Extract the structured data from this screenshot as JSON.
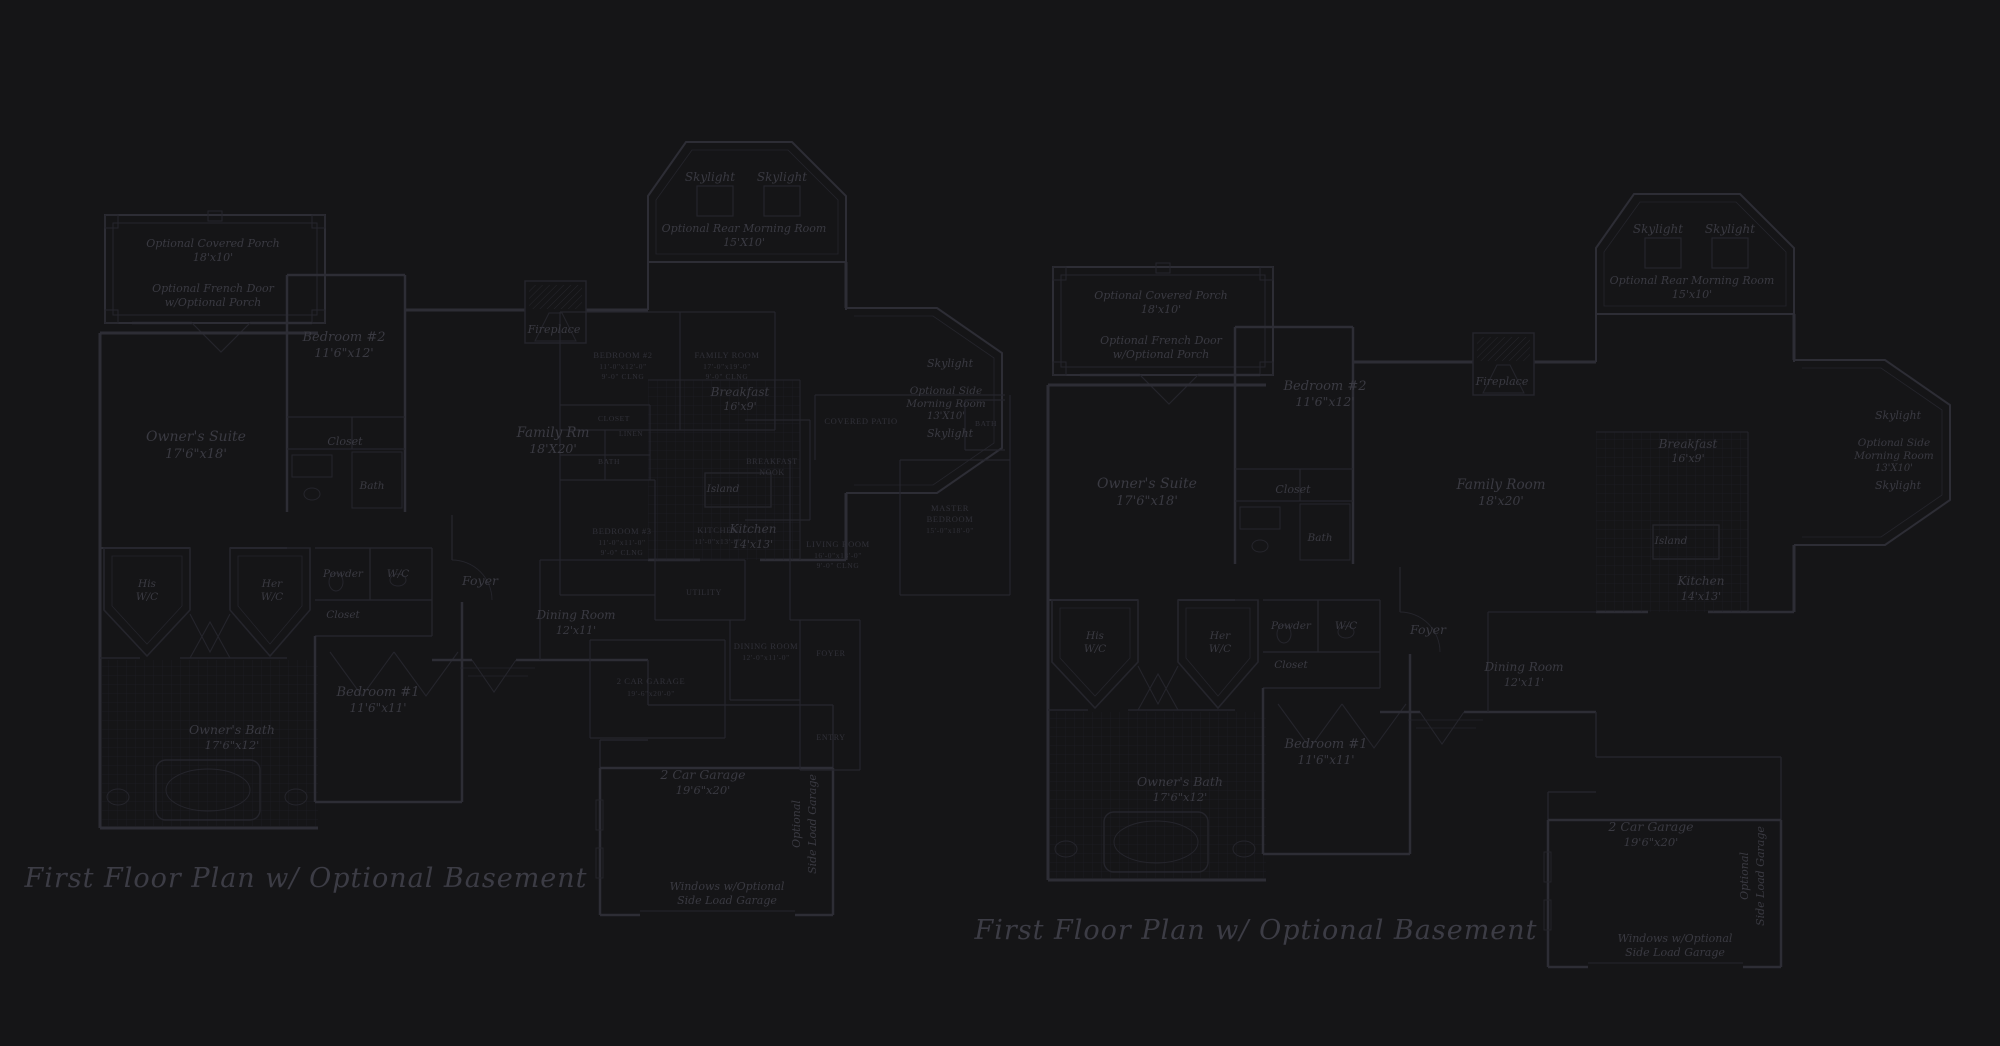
{
  "background": "#151517",
  "colors": {
    "wall_line": "#2d2d35",
    "thin_line": "#25252c",
    "overlay_line": "#26262d",
    "label_text": "#3a3a42",
    "smallcaps_text": "#313139",
    "title_text": "#3c3c45",
    "tile_grid": "#1e1e24"
  },
  "titles": [
    {
      "text": "First Floor Plan  w/ Optional Basement",
      "x": 306,
      "y": 887
    },
    {
      "text": "First Floor Plan  w/ Optional Basement",
      "x": 1256,
      "y": 939
    }
  ],
  "plans": [
    {
      "id": "left-plan",
      "labels": [
        {
          "t": "Optional Covered Porch",
          "x": 213,
          "y": 247,
          "s": 11
        },
        {
          "t": "18'x10'",
          "x": 213,
          "y": 261,
          "s": 11
        },
        {
          "t": "Optional French Door",
          "x": 213,
          "y": 292,
          "s": 11
        },
        {
          "t": "w/Optional Porch",
          "x": 213,
          "y": 306,
          "s": 11
        },
        {
          "t": "Owner's Suite",
          "x": 196,
          "y": 441,
          "s": 14
        },
        {
          "t": "17'6\"x18'",
          "x": 196,
          "y": 458,
          "s": 13
        },
        {
          "t": "Bedroom #2",
          "x": 344,
          "y": 341,
          "s": 13
        },
        {
          "t": "11'6\"x12'",
          "x": 344,
          "y": 357,
          "s": 12.5
        },
        {
          "t": "Closet",
          "x": 345,
          "y": 445,
          "s": 11
        },
        {
          "t": "Bath",
          "x": 372,
          "y": 489,
          "s": 10.5
        },
        {
          "t": "Fireplace",
          "x": 554,
          "y": 333,
          "s": 11
        },
        {
          "t": "Skylight",
          "x": 710,
          "y": 181,
          "s": 12
        },
        {
          "t": "Skylight",
          "x": 782,
          "y": 181,
          "s": 12
        },
        {
          "t": "Optional Rear Morning Room",
          "x": 744,
          "y": 232,
          "s": 11
        },
        {
          "t": "15'X10'",
          "x": 744,
          "y": 246,
          "s": 11
        },
        {
          "t": "Family Rm",
          "x": 553,
          "y": 437,
          "s": 13.5
        },
        {
          "t": "18'X20'",
          "x": 553,
          "y": 453,
          "s": 12.5
        },
        {
          "t": "Breakfast",
          "x": 740,
          "y": 396,
          "s": 12
        },
        {
          "t": "16'x9'",
          "x": 740,
          "y": 410,
          "s": 11
        },
        {
          "t": "Island",
          "x": 723,
          "y": 492,
          "s": 10.5
        },
        {
          "t": "Kitchen",
          "x": 753,
          "y": 533,
          "s": 12
        },
        {
          "t": "14'x13'",
          "x": 753,
          "y": 548,
          "s": 11
        },
        {
          "t": "His",
          "x": 147,
          "y": 587,
          "s": 10.5
        },
        {
          "t": "W/C",
          "x": 147,
          "y": 600,
          "s": 10.5
        },
        {
          "t": "Her",
          "x": 272,
          "y": 587,
          "s": 10.5
        },
        {
          "t": "W/C",
          "x": 272,
          "y": 600,
          "s": 10.5
        },
        {
          "t": "Powder",
          "x": 343,
          "y": 577,
          "s": 10.5
        },
        {
          "t": "W/C",
          "x": 398,
          "y": 577,
          "s": 10.5
        },
        {
          "t": "Closet",
          "x": 343,
          "y": 618,
          "s": 10.5
        },
        {
          "t": "Foyer",
          "x": 480,
          "y": 585,
          "s": 12.5
        },
        {
          "t": "Dining Room",
          "x": 576,
          "y": 619,
          "s": 12
        },
        {
          "t": "12'x11'",
          "x": 576,
          "y": 634,
          "s": 11
        },
        {
          "t": "Bedroom #1",
          "x": 378,
          "y": 696,
          "s": 13
        },
        {
          "t": "11'6\"x11'",
          "x": 378,
          "y": 712,
          "s": 12
        },
        {
          "t": "Owner's Bath",
          "x": 232,
          "y": 734,
          "s": 12.5
        },
        {
          "t": "17'6\"x12'",
          "x": 232,
          "y": 749,
          "s": 11.5
        },
        {
          "t": "2 Car Garage",
          "x": 703,
          "y": 779,
          "s": 12.5
        },
        {
          "t": "19'6\"x20'",
          "x": 703,
          "y": 794,
          "s": 11.5
        },
        {
          "t": "Windows w/Optional",
          "x": 727,
          "y": 890,
          "s": 11
        },
        {
          "t": "Side Load Garage",
          "x": 727,
          "y": 904,
          "s": 11
        },
        {
          "t": "Skylight",
          "x": 950,
          "y": 367,
          "s": 11
        },
        {
          "t": "Optional Side",
          "x": 946,
          "y": 394,
          "s": 10.5
        },
        {
          "t": "Morning Room",
          "x": 946,
          "y": 407,
          "s": 10.5
        },
        {
          "t": "13'X10'",
          "x": 946,
          "y": 419,
          "s": 10
        },
        {
          "t": "Skylight",
          "x": 950,
          "y": 437,
          "s": 11
        }
      ],
      "vertical_labels": [
        {
          "t": "Optional",
          "x": 800,
          "y": 824,
          "s": 11
        },
        {
          "t": "Side Load Garage",
          "x": 816,
          "y": 824,
          "s": 11
        }
      ]
    },
    {
      "id": "right-plan",
      "labels": [
        {
          "t": "Optional Covered Porch",
          "x": 1161,
          "y": 299,
          "s": 11
        },
        {
          "t": "18'x10'",
          "x": 1161,
          "y": 313,
          "s": 11
        },
        {
          "t": "Optional French Door",
          "x": 1161,
          "y": 344,
          "s": 11
        },
        {
          "t": "w/Optional Porch",
          "x": 1161,
          "y": 358,
          "s": 11
        },
        {
          "t": "Owner's Suite",
          "x": 1147,
          "y": 488,
          "s": 14
        },
        {
          "t": "17'6\"x18'",
          "x": 1147,
          "y": 505,
          "s": 13
        },
        {
          "t": "Bedroom #2",
          "x": 1325,
          "y": 390,
          "s": 13
        },
        {
          "t": "11'6\"x12'",
          "x": 1325,
          "y": 406,
          "s": 12.5
        },
        {
          "t": "Closet",
          "x": 1293,
          "y": 493,
          "s": 11
        },
        {
          "t": "Bath",
          "x": 1320,
          "y": 541,
          "s": 10.5
        },
        {
          "t": "Fireplace",
          "x": 1502,
          "y": 385,
          "s": 11
        },
        {
          "t": "Skylight",
          "x": 1658,
          "y": 233,
          "s": 12
        },
        {
          "t": "Skylight",
          "x": 1730,
          "y": 233,
          "s": 12
        },
        {
          "t": "Optional Rear Morning Room",
          "x": 1692,
          "y": 284,
          "s": 11
        },
        {
          "t": "15'x10'",
          "x": 1692,
          "y": 298,
          "s": 11
        },
        {
          "t": "Family Room",
          "x": 1501,
          "y": 489,
          "s": 13.5
        },
        {
          "t": "18'x20'",
          "x": 1501,
          "y": 505,
          "s": 12.5
        },
        {
          "t": "Breakfast",
          "x": 1688,
          "y": 448,
          "s": 12
        },
        {
          "t": "16'x9'",
          "x": 1688,
          "y": 462,
          "s": 11
        },
        {
          "t": "Island",
          "x": 1671,
          "y": 544,
          "s": 10.5
        },
        {
          "t": "Kitchen",
          "x": 1701,
          "y": 585,
          "s": 12
        },
        {
          "t": "14'x13'",
          "x": 1701,
          "y": 600,
          "s": 11
        },
        {
          "t": "His",
          "x": 1095,
          "y": 639,
          "s": 10.5
        },
        {
          "t": "W/C",
          "x": 1095,
          "y": 652,
          "s": 10.5
        },
        {
          "t": "Her",
          "x": 1220,
          "y": 639,
          "s": 10.5
        },
        {
          "t": "W/C",
          "x": 1220,
          "y": 652,
          "s": 10.5
        },
        {
          "t": "Powder",
          "x": 1291,
          "y": 629,
          "s": 10.5
        },
        {
          "t": "W/C",
          "x": 1346,
          "y": 629,
          "s": 10.5
        },
        {
          "t": "Closet",
          "x": 1291,
          "y": 668,
          "s": 10.5
        },
        {
          "t": "Foyer",
          "x": 1428,
          "y": 634,
          "s": 12.5
        },
        {
          "t": "Dining Room",
          "x": 1524,
          "y": 671,
          "s": 12
        },
        {
          "t": "12'x11'",
          "x": 1524,
          "y": 686,
          "s": 11
        },
        {
          "t": "Bedroom #1",
          "x": 1326,
          "y": 748,
          "s": 13
        },
        {
          "t": "11'6\"x11'",
          "x": 1326,
          "y": 764,
          "s": 12
        },
        {
          "t": "Owner's Bath",
          "x": 1180,
          "y": 786,
          "s": 12.5
        },
        {
          "t": "17'6\"x12'",
          "x": 1180,
          "y": 801,
          "s": 11.5
        },
        {
          "t": "2 Car Garage",
          "x": 1651,
          "y": 831,
          "s": 12.5
        },
        {
          "t": "19'6\"x20'",
          "x": 1651,
          "y": 846,
          "s": 11.5
        },
        {
          "t": "Windows w/Optional",
          "x": 1675,
          "y": 942,
          "s": 11
        },
        {
          "t": "Side Load Garage",
          "x": 1675,
          "y": 956,
          "s": 11
        },
        {
          "t": "Skylight",
          "x": 1898,
          "y": 419,
          "s": 11
        },
        {
          "t": "Optional Side",
          "x": 1894,
          "y": 446,
          "s": 10.5
        },
        {
          "t": "Morning Room",
          "x": 1894,
          "y": 459,
          "s": 10.5
        },
        {
          "t": "13'X10'",
          "x": 1894,
          "y": 471,
          "s": 10
        },
        {
          "t": "Skylight",
          "x": 1898,
          "y": 489,
          "s": 11
        }
      ],
      "vertical_labels": [
        {
          "t": "Optional",
          "x": 1748,
          "y": 876,
          "s": 11
        },
        {
          "t": "Side Load Garage",
          "x": 1764,
          "y": 876,
          "s": 11
        }
      ]
    }
  ],
  "overlay_plan": {
    "labels": [
      {
        "t": "BEDROOM #2",
        "x": 623,
        "y": 358,
        "s": 8.5
      },
      {
        "t": "11'-0\"x12'-0\"",
        "x": 623,
        "y": 369,
        "s": 7.5
      },
      {
        "t": "9'-0\" CLNG",
        "x": 623,
        "y": 379,
        "s": 7.5
      },
      {
        "t": "FAMILY ROOM",
        "x": 727,
        "y": 358,
        "s": 8.5
      },
      {
        "t": "17'-0\"x19'-0\"",
        "x": 727,
        "y": 369,
        "s": 7.5
      },
      {
        "t": "9'-0\" CLNG",
        "x": 727,
        "y": 379,
        "s": 7.5
      },
      {
        "t": "CLOSET",
        "x": 614,
        "y": 421,
        "s": 7.5
      },
      {
        "t": "LINEN",
        "x": 631,
        "y": 436,
        "s": 7
      },
      {
        "t": "BATH",
        "x": 609,
        "y": 464,
        "s": 7.5
      },
      {
        "t": "BEDROOM #3",
        "x": 622,
        "y": 534,
        "s": 8.5
      },
      {
        "t": "11'-0\"x11'-0\"",
        "x": 622,
        "y": 545,
        "s": 7.5
      },
      {
        "t": "9'-0\" CLNG",
        "x": 622,
        "y": 555,
        "s": 7.5
      },
      {
        "t": "KITCHEN",
        "x": 718,
        "y": 533,
        "s": 8.5
      },
      {
        "t": "11'-0\"x13'-0\"",
        "x": 718,
        "y": 544,
        "s": 7.5
      },
      {
        "t": "BREAKFAST",
        "x": 772,
        "y": 464,
        "s": 8
      },
      {
        "t": "NOOK",
        "x": 772,
        "y": 475,
        "s": 8
      },
      {
        "t": "COVERED PATIO",
        "x": 861,
        "y": 424,
        "s": 8.5
      },
      {
        "t": "BATH",
        "x": 986,
        "y": 426,
        "s": 7.5
      },
      {
        "t": "MASTER",
        "x": 950,
        "y": 511,
        "s": 8.5
      },
      {
        "t": "BEDROOM",
        "x": 950,
        "y": 522,
        "s": 8.5
      },
      {
        "t": "15'-0\"x18'-0\"",
        "x": 950,
        "y": 533,
        "s": 7.5
      },
      {
        "t": "LIVING ROOM",
        "x": 838,
        "y": 547,
        "s": 8.5
      },
      {
        "t": "16'-0\"x18'-0\"",
        "x": 838,
        "y": 558,
        "s": 7.5
      },
      {
        "t": "9'-0\" CLNG",
        "x": 838,
        "y": 568,
        "s": 7.5
      },
      {
        "t": "UTILITY",
        "x": 704,
        "y": 595,
        "s": 8
      },
      {
        "t": "DINING ROOM",
        "x": 766,
        "y": 649,
        "s": 8.5
      },
      {
        "t": "12'-0\"x11'-0\"",
        "x": 766,
        "y": 660,
        "s": 7.5
      },
      {
        "t": "FOYER",
        "x": 831,
        "y": 656,
        "s": 8
      },
      {
        "t": "ENTRY",
        "x": 831,
        "y": 740,
        "s": 8
      },
      {
        "t": "2 CAR GARAGE",
        "x": 651,
        "y": 684,
        "s": 8.5
      },
      {
        "t": "19'-6\"x20'-0\"",
        "x": 651,
        "y": 696,
        "s": 7.5
      }
    ]
  }
}
